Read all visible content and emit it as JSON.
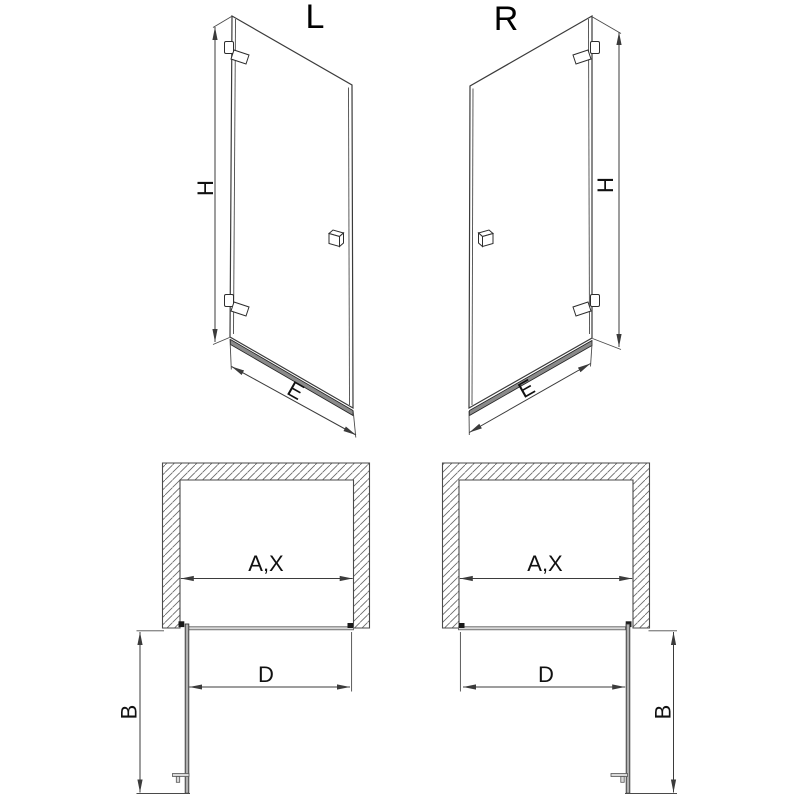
{
  "figures": {
    "door_left": {
      "title": "L",
      "dims": {
        "height": "H",
        "width": "E"
      }
    },
    "door_right": {
      "title": "R",
      "dims": {
        "height": "H",
        "width": "E"
      }
    },
    "plan_left": {
      "dims": {
        "opening": "A,X",
        "door_width": "D",
        "swing_depth": "B"
      }
    },
    "plan_right": {
      "dims": {
        "opening": "A,X",
        "door_width": "D",
        "swing_depth": "B"
      }
    }
  },
  "colors": {
    "line": "#3b3b3b",
    "label": "#111111",
    "hatch": "#666666",
    "profile_gray": "#b0b0b0",
    "rail_fill": "#8a8a8a",
    "background": "#ffffff"
  }
}
